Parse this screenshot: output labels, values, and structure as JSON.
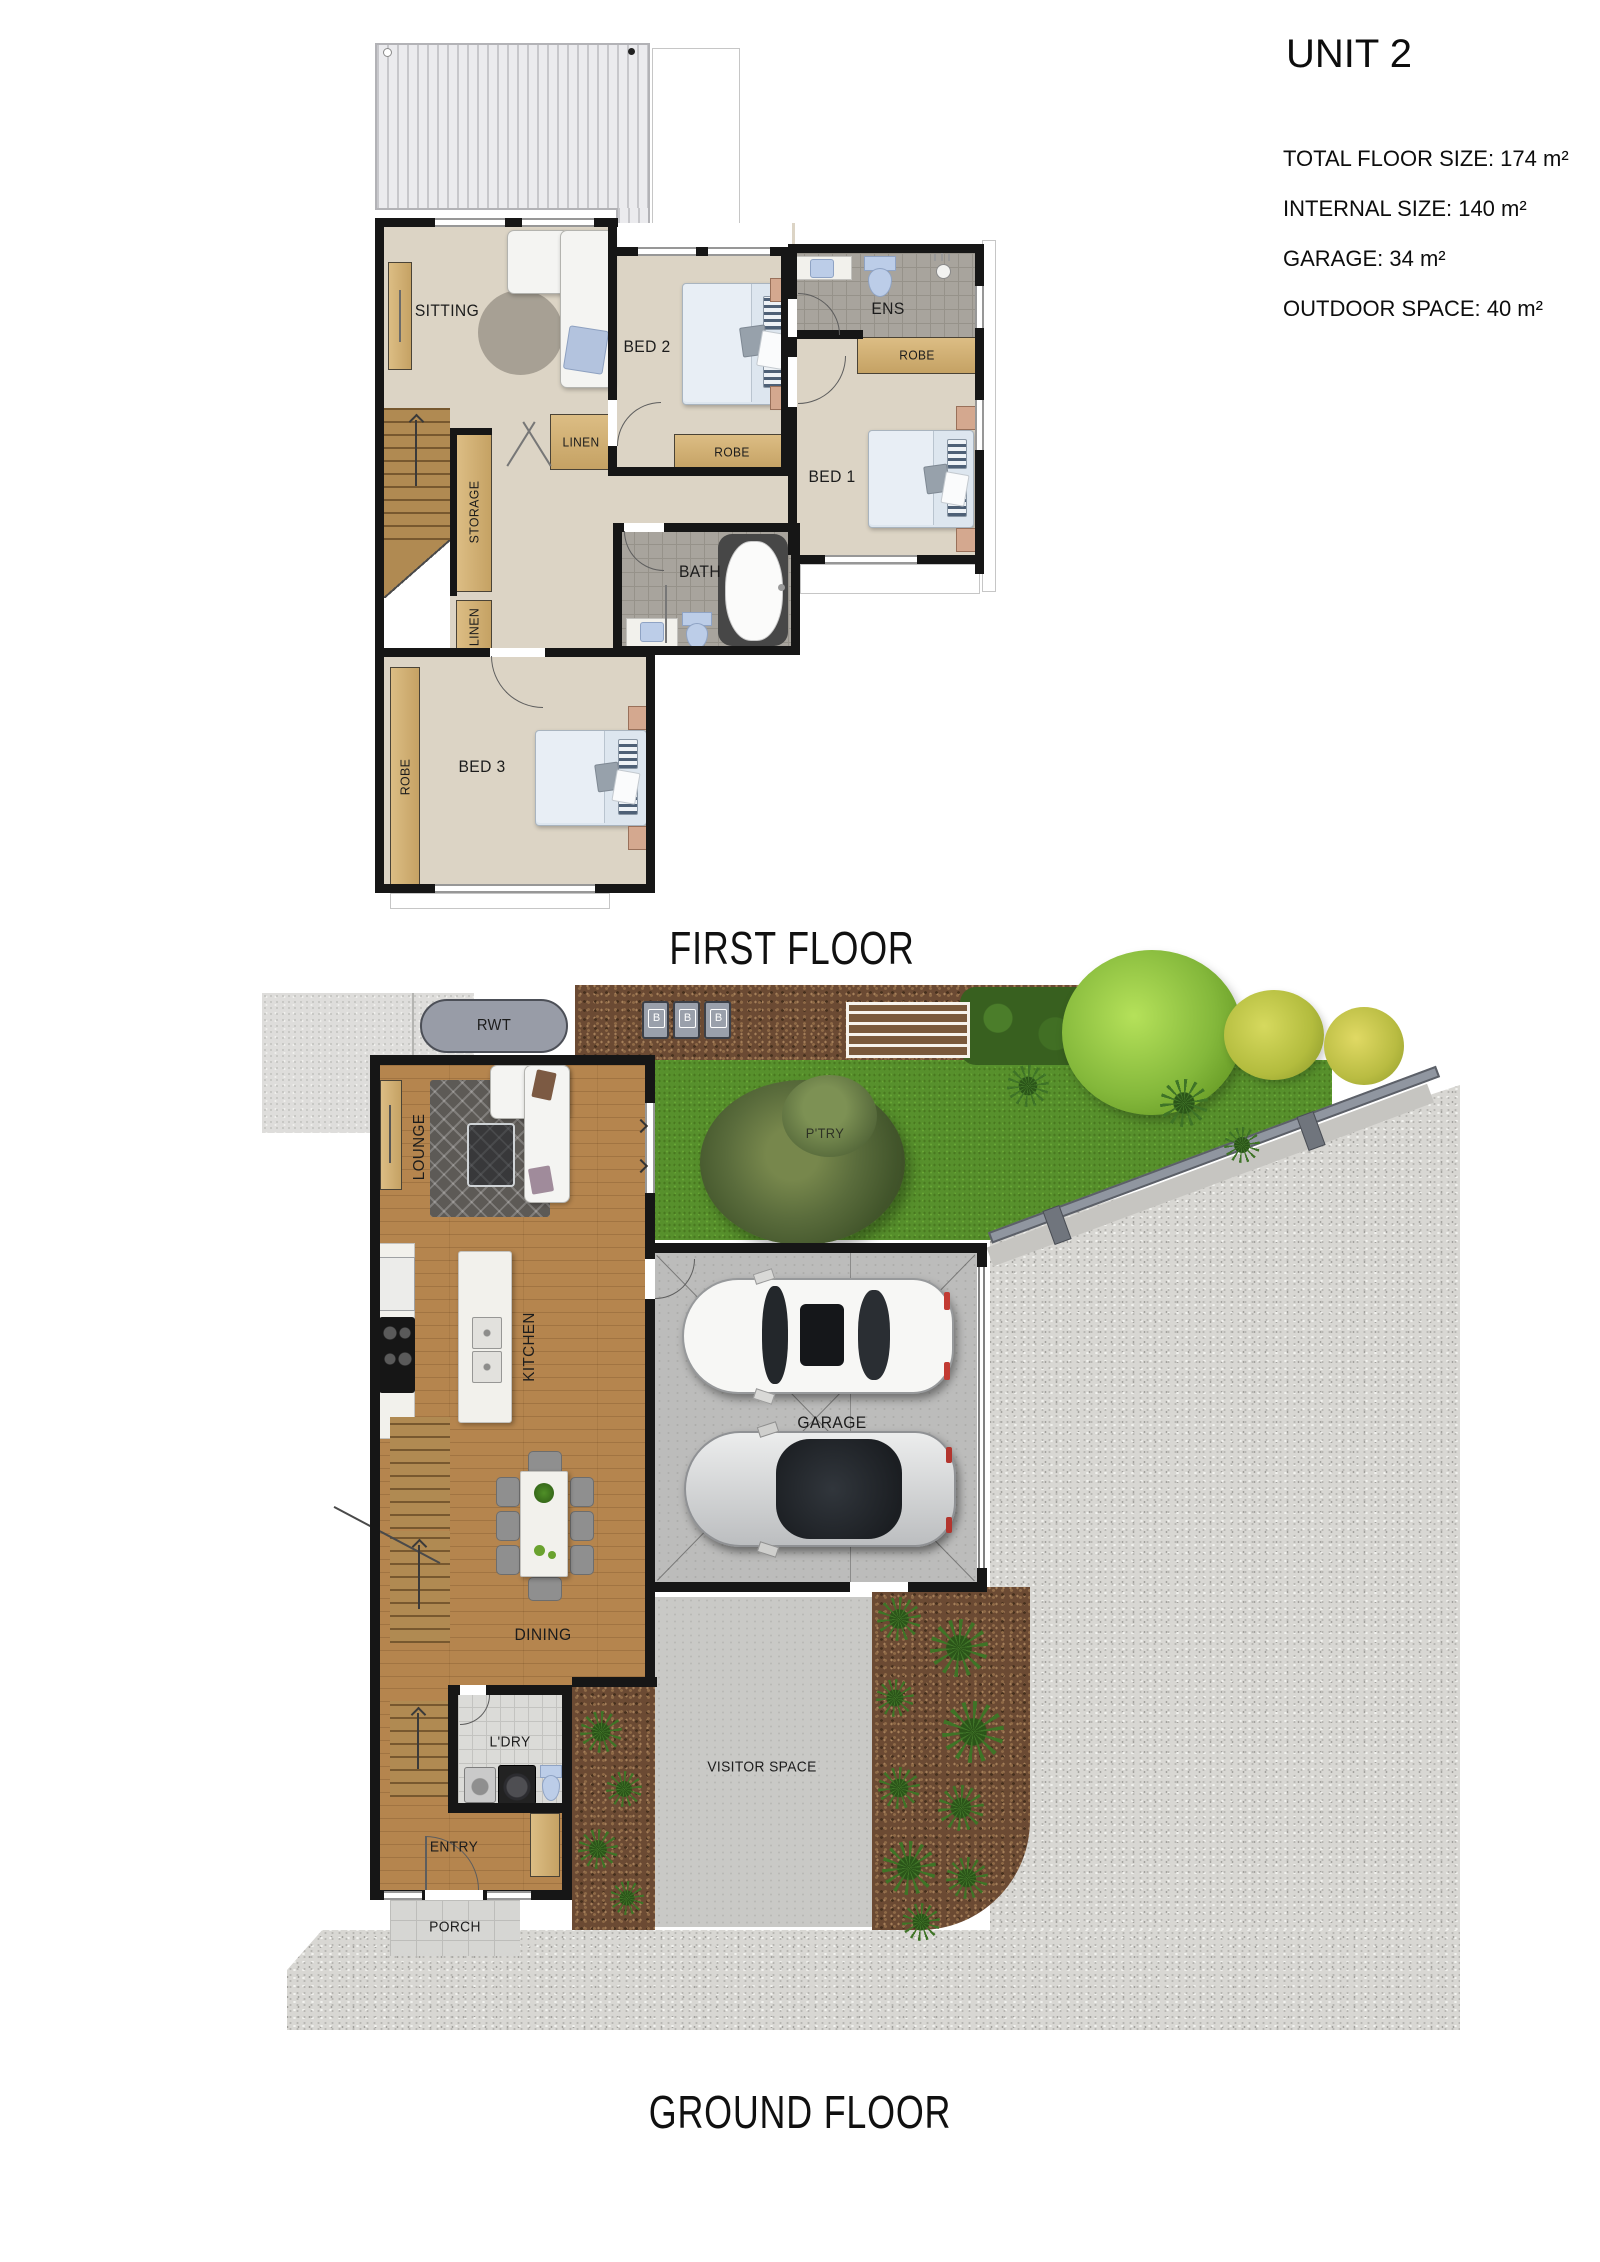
{
  "info_panel": {
    "title": "UNIT 2",
    "stats": [
      "TOTAL FLOOR SIZE: 174 m²",
      "INTERNAL SIZE: 140 m²",
      "GARAGE: 34 m²",
      "OUTDOOR SPACE: 40 m²"
    ]
  },
  "first_floor": {
    "caption": "FIRST FLOOR",
    "labels": {
      "sitting": "SITTING",
      "bed2": "BED 2",
      "ens": "ENS",
      "robe_ens": "ROBE",
      "robe_bed2": "ROBE",
      "bed1": "BED 1",
      "linen_hall": "LINEN",
      "storage": "STORAGE",
      "linen_stairs": "LINEN",
      "bath": "BATH",
      "bed3": "BED 3",
      "robe_bed3": "ROBE"
    }
  },
  "ground_floor": {
    "caption": "GROUND FLOOR",
    "labels": {
      "rwt": "RWT",
      "lounge": "LOUNGE",
      "kitchen": "KITCHEN",
      "pantry": "P'TRY",
      "garage": "GARAGE",
      "dining": "DINING",
      "laundry": "L'DRY",
      "entry": "ENTRY",
      "porch": "PORCH",
      "visitor": "VISITOR SPACE"
    },
    "bins": [
      "B",
      "B",
      "B"
    ]
  },
  "colors": {
    "wall": "#161616",
    "floor_first": "#dcd4c5",
    "floor_timber": "#b5854e",
    "tile_grey": "#a8a49d",
    "cabinet_wood": "#d2b176",
    "grass": "#57902c",
    "mulch": "#6b4a33",
    "gravel": "#d8d7d3",
    "concrete": "#c9c9c6",
    "fixture_blue": "#bccde8"
  }
}
